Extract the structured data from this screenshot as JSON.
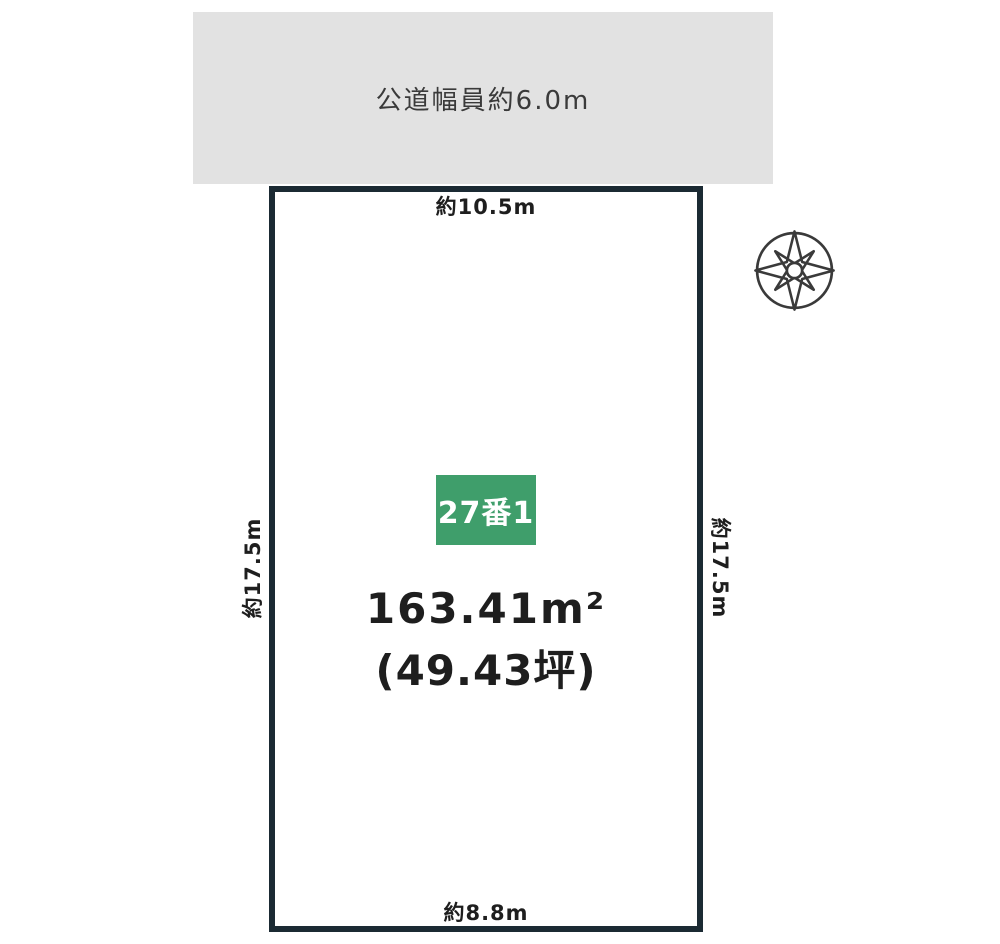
{
  "road": {
    "label": "公道幅員約6.0m"
  },
  "plot": {
    "lot_number": "27番1",
    "area_sqm": "163.41m²",
    "area_tsubo": "(49.43坪)"
  },
  "dimensions": {
    "top": "約10.5m",
    "bottom": "約8.8m",
    "left": "約17.5m",
    "right": "約17.5m"
  },
  "icons": {
    "compass": "compass-rose-icon"
  },
  "colors": {
    "plot_border": "#1b2a33",
    "road_bg": "#e2e2e2",
    "badge_bg": "#3f9e6b",
    "badge_text": "#ffffff",
    "text": "#2b2b2b"
  }
}
